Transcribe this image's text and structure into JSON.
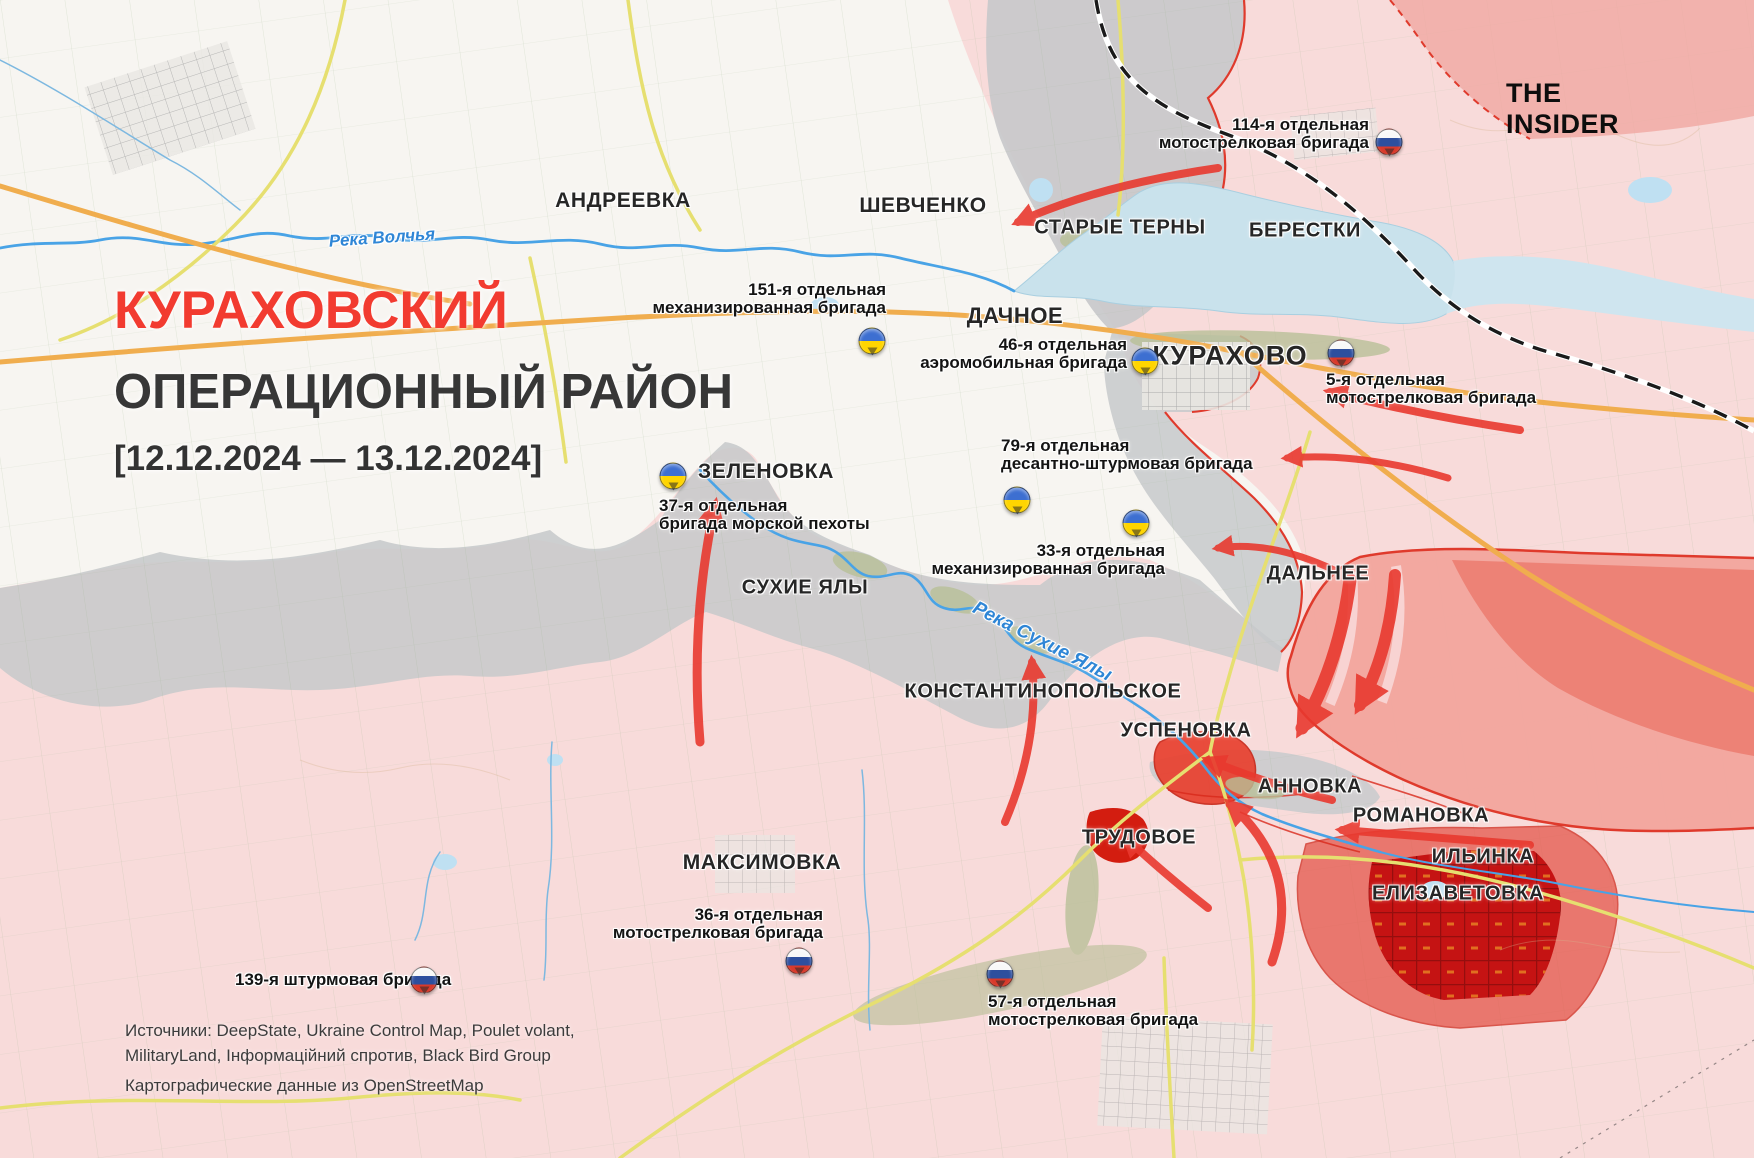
{
  "branding": {
    "logo": "THE INSIDER"
  },
  "title": {
    "line1": "КУРАХОВСКИЙ",
    "line2": "ОПЕРАЦИОННЫЙ РАЙОН",
    "date_range": "[12.12.2024 — 13.12.2024]"
  },
  "sources": {
    "line1": "Источники: DeepState, Ukraine Control Map, Poulet volant,",
    "line2": "MilitaryLand, Інформаційний спротив, Black Bird Group",
    "line3": "Картографические данные из OpenStreetMap"
  },
  "colors": {
    "ua_controlled": "#f7f5f1",
    "ru_controlled": "#f8dbda",
    "contested_gray": "#c7c9cb",
    "advance_salmon": "#f2a59d",
    "advance_red": "#e8392f",
    "captured_dark_red": "#c51313",
    "title_red": "#f23b30",
    "water": "#c9e2ec",
    "river": "#49a3e6",
    "road_orange": "#f0ad4e",
    "road_yellow": "#e6df70",
    "railroad": "#1a1a1a",
    "ua_flag_blue": "#3d6fd1",
    "ua_flag_yellow": "#ffd500",
    "ru_flag_blue": "#2d4f9e",
    "ru_flag_red": "#d93a2b"
  },
  "map": {
    "towns": [
      {
        "name": "АНДРЕЕВКА"
      },
      {
        "name": "ШЕВЧЕНКО"
      },
      {
        "name": "СТАРЫЕ ТЕРНЫ"
      },
      {
        "name": "БЕРЕСТКИ"
      },
      {
        "name": "ДАЧНОЕ"
      },
      {
        "name": "КУРАХОВО"
      },
      {
        "name": "ЗЕЛЕНОВКА"
      },
      {
        "name": "ДАЛЬНЕЕ"
      },
      {
        "name": "СУХИЕ ЯЛЫ"
      },
      {
        "name": "КОНСТАНТИНОПОЛЬСКОЕ"
      },
      {
        "name": "УСПЕНОВКА"
      },
      {
        "name": "АННОВКА"
      },
      {
        "name": "РОМАНОВКА"
      },
      {
        "name": "ТРУДОВОЕ"
      },
      {
        "name": "ИЛЬИНКА"
      },
      {
        "name": "ЕЛИЗАВЕТОВКА"
      },
      {
        "name": "МАКСИМОВКА"
      }
    ],
    "rivers": [
      {
        "name": "Река Волчья"
      },
      {
        "name": "Река Сухие Ялы"
      }
    ],
    "units": [
      {
        "line1": "114-я отдельная",
        "line2": "мотострелковая бригада",
        "country": "ru"
      },
      {
        "line1": "151-я отдельная",
        "line2": "механизированная бригада",
        "country": "ua"
      },
      {
        "line1": "46-я отдельная",
        "line2": "аэромобильная бригада",
        "country": "ua"
      },
      {
        "line1": "5-я отдельная",
        "line2": "мотострелковая бригада",
        "country": "ru"
      },
      {
        "line1": "79-я отдельная",
        "line2": "десантно-штурмовая бригада",
        "country": "ua"
      },
      {
        "line1": "37-я отдельная",
        "line2": "бригада морской пехоты",
        "country": "ua"
      },
      {
        "line1": "33-я отдельная",
        "line2": "механизированная бригада",
        "country": "ua"
      },
      {
        "line1": "36-я отдельная",
        "line2": "мотострелковая бригада",
        "country": "ru"
      },
      {
        "line1": "139-я штурмовая бригада",
        "country": "ru"
      },
      {
        "line1": "57-я отдельная",
        "line2": "мотострелковая бригада",
        "country": "ru"
      }
    ],
    "attack_arrows": [
      {
        "from": [
          1218,
          168
        ],
        "via": [
          1100,
          185
        ],
        "to": [
          1018,
          222
        ],
        "w": 8
      },
      {
        "from": [
          1520,
          430
        ],
        "via": [
          1420,
          415
        ],
        "to": [
          1330,
          392
        ],
        "w": 8
      },
      {
        "from": [
          1448,
          478
        ],
        "via": [
          1360,
          452
        ],
        "to": [
          1287,
          458
        ],
        "w": 7
      },
      {
        "from": [
          1334,
          570
        ],
        "via": [
          1270,
          540
        ],
        "to": [
          1218,
          548
        ],
        "w": 7
      },
      {
        "from": [
          700,
          742
        ],
        "via": [
          690,
          620
        ],
        "to": [
          715,
          505
        ],
        "w": 9
      },
      {
        "from": [
          1005,
          822
        ],
        "via": [
          1040,
          740
        ],
        "to": [
          1032,
          662
        ],
        "w": 8
      },
      {
        "from": [
          1350,
          580
        ],
        "via": [
          1340,
          660
        ],
        "to": [
          1302,
          728
        ],
        "w": 13
      },
      {
        "from": [
          1395,
          575
        ],
        "via": [
          1390,
          650
        ],
        "to": [
          1360,
          705
        ],
        "w": 12
      },
      {
        "from": [
          1332,
          800
        ],
        "via": [
          1270,
          785
        ],
        "to": [
          1208,
          760
        ],
        "w": 8
      },
      {
        "from": [
          1530,
          845
        ],
        "via": [
          1440,
          838
        ],
        "to": [
          1342,
          830
        ],
        "w": 8
      },
      {
        "from": [
          1272,
          962
        ],
        "via": [
          1304,
          870
        ],
        "to": [
          1230,
          804
        ],
        "w": 9
      },
      {
        "from": [
          1208,
          908
        ],
        "via": [
          1162,
          872
        ],
        "to": [
          1126,
          838
        ],
        "w": 8
      }
    ]
  }
}
